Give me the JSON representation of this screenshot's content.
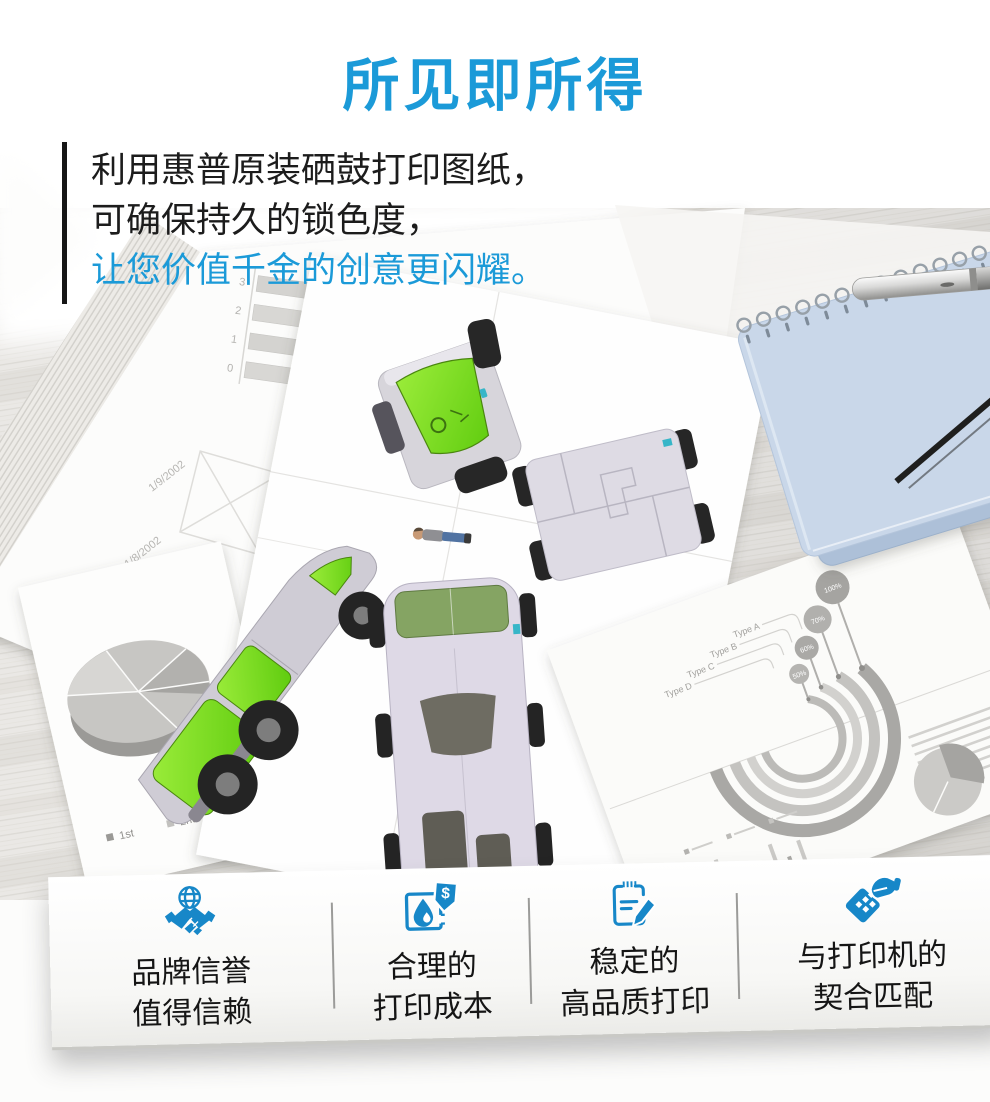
{
  "title": "所见即所得",
  "intro": {
    "line1": "利用惠普原装硒鼓打印图纸，",
    "line2": "可确保持久的锁色度，",
    "line3": "让您价值千金的创意更闪耀。"
  },
  "features": [
    {
      "icon": "brand-trust",
      "line1": "品牌信誉",
      "line2": "值得信赖"
    },
    {
      "icon": "print-cost",
      "line1": "合理的",
      "line2": "打印成本"
    },
    {
      "icon": "print-quality",
      "line1": "稳定的",
      "line2": "高品质打印"
    },
    {
      "icon": "printer-match",
      "line1": "与打印机的",
      "line2": "契合匹配"
    }
  ],
  "artwork": {
    "barchart_dates": {
      "date1": "1/9/2002",
      "date2": "1/8/2002"
    },
    "barchart_ticks": {
      "t3": "3",
      "t2": "2",
      "t1": "1",
      "t0": "0"
    },
    "pie_legend": {
      "first": "1st",
      "second": "2nd"
    },
    "infographic": {
      "type_a": "Type A",
      "type_b": "Type B",
      "type_c": "Type C",
      "type_d": "Type D",
      "v1": "50%",
      "v2": "60%",
      "v3": "70%",
      "v4": "100%",
      "bar_heights": [
        26,
        38,
        20,
        32,
        28,
        44,
        18,
        30,
        24,
        40,
        22,
        34
      ]
    }
  },
  "colors": {
    "accent_blue": "#1b9ad8",
    "icon_blue": "#1787c8",
    "text_dark": "#1c1c1c"
  }
}
